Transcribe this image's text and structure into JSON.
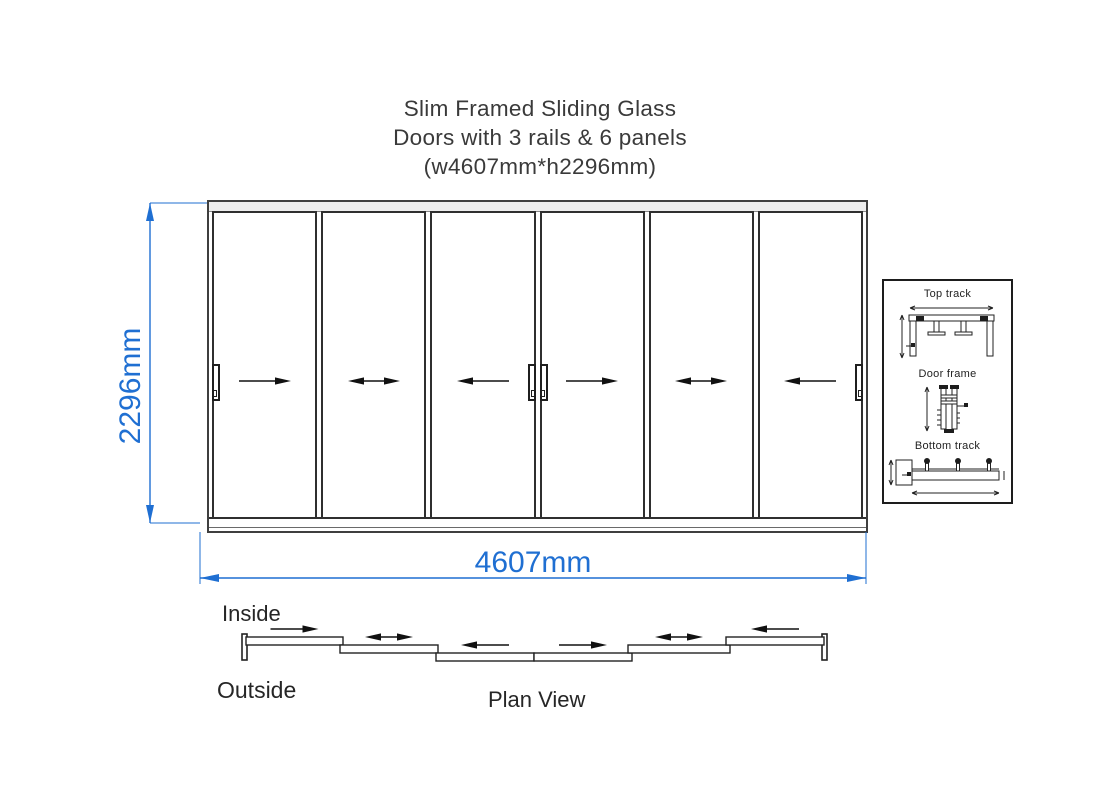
{
  "title": {
    "lines": [
      "Slim Framed Sliding Glass",
      "Doors with 3 rails & 6 panels",
      "(w4607mm*h2296mm)"
    ]
  },
  "dimensions": {
    "width": "4607mm",
    "height": "2296mm",
    "color": "#1f6fd2"
  },
  "elevation": {
    "rails": 3,
    "panel_count": 6,
    "panels": [
      {
        "arrow": "right",
        "handles": [
          "left"
        ]
      },
      {
        "arrow": "both",
        "handles": []
      },
      {
        "arrow": "left",
        "handles": [
          "right"
        ]
      },
      {
        "arrow": "right",
        "handles": [
          "left"
        ]
      },
      {
        "arrow": "both",
        "handles": []
      },
      {
        "arrow": "left",
        "handles": [
          "right"
        ]
      }
    ]
  },
  "details": {
    "sections": [
      {
        "label": "Top track"
      },
      {
        "label": "Door frame"
      },
      {
        "label": "Bottom track"
      }
    ]
  },
  "plan": {
    "inside_label": "Inside",
    "outside_label": "Outside",
    "caption": "Plan View",
    "posts": [
      {
        "x": 14,
        "y": 16
      },
      {
        "x": 594,
        "y": 16
      }
    ],
    "panels": [
      {
        "x": 18,
        "y": 19,
        "w": 97,
        "arrow": "right"
      },
      {
        "x": 112,
        "y": 27,
        "w": 98,
        "arrow": "both"
      },
      {
        "x": 208,
        "y": 35,
        "w": 98,
        "arrow": "left"
      },
      {
        "x": 306,
        "y": 35,
        "w": 98,
        "arrow": "right"
      },
      {
        "x": 400,
        "y": 27,
        "w": 102,
        "arrow": "both"
      },
      {
        "x": 498,
        "y": 19,
        "w": 98,
        "arrow": "left"
      }
    ]
  },
  "colors": {
    "line": "#2e2e2e",
    "dimension": "#1f6fd2"
  }
}
